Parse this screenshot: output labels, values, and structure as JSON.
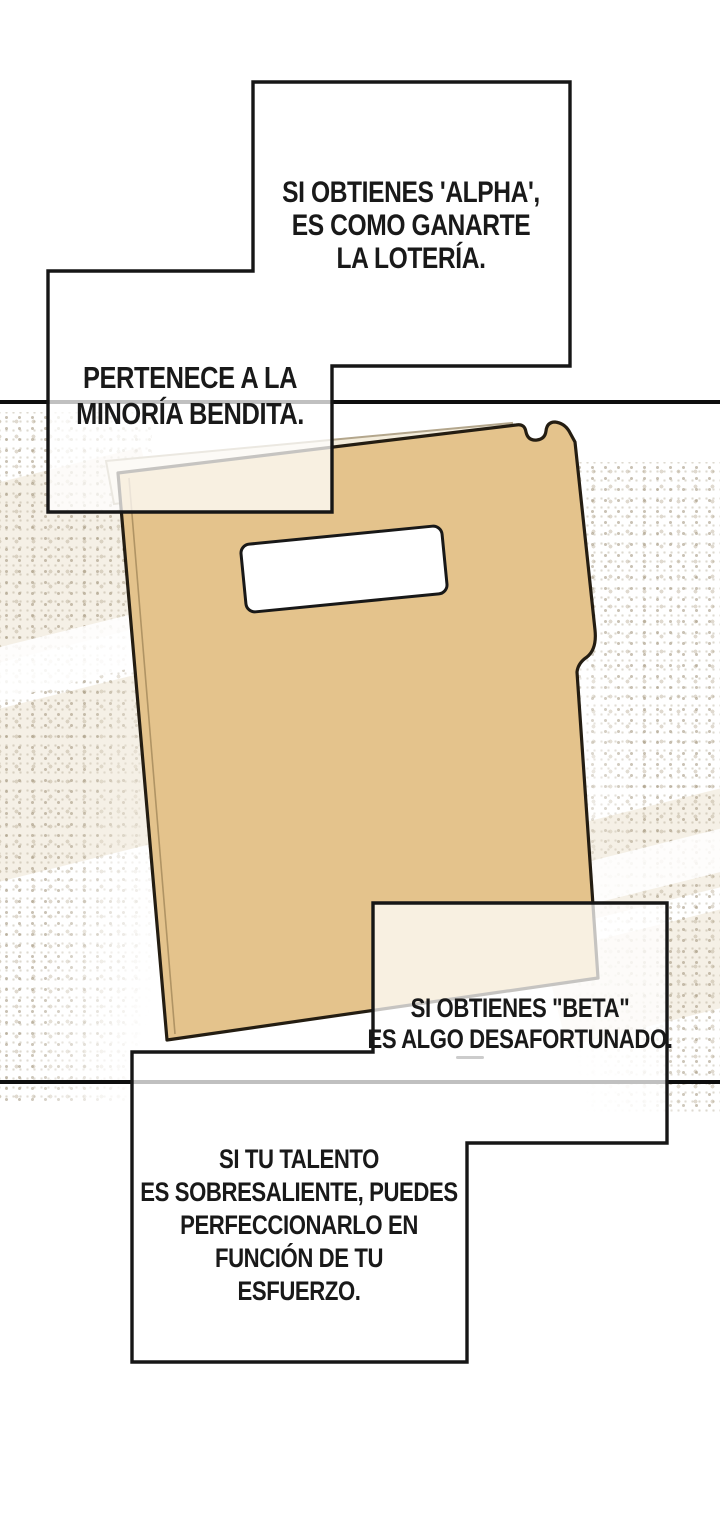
{
  "scene": {
    "type": "comic-page",
    "language": "es"
  },
  "colors": {
    "background": "#ffffff",
    "panel_line": "#0e0e0e",
    "bubble_border": "#161616",
    "bubble_fill": "rgba(255,255,255,0.74)",
    "folder_body": "#e4c38c",
    "folder_flap": "#f3ecdb",
    "folder_label": "#ffffff",
    "speckle": "#9e9178",
    "band": "#ece4d2"
  },
  "speech_bubbles": [
    {
      "id": "alpha",
      "lines": [
        "SI OBTIENES 'ALPHA',",
        "ES COMO GANARTE",
        "LA LOTERÍA."
      ]
    },
    {
      "id": "minoria",
      "lines": [
        "PERTENECE A LA",
        "MINORÍA BENDITA."
      ]
    },
    {
      "id": "beta",
      "lines": [
        "SI OBTIENES \"BETA\"",
        "ES ALGO DESAFORTUNADO."
      ]
    },
    {
      "id": "talento",
      "lines": [
        "SI TU TALENTO",
        "ES SOBRESALIENTE, PUEDES",
        "PERFECCIONARLO EN",
        "FUNCIÓN DE TU",
        "ESFUERZO."
      ]
    }
  ],
  "folder": {
    "label_text": ""
  }
}
